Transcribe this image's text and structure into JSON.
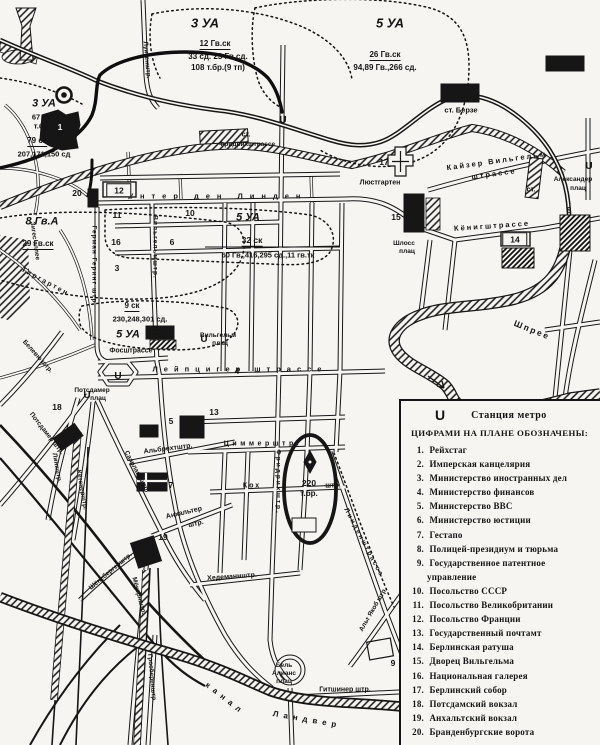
{
  "map": {
    "ink": "#141414",
    "paper": "#f6f5f1",
    "unit_labels": [
      {
        "t": "3 УА",
        "x": 205,
        "y": 23,
        "s": 13,
        "it": 1,
        "n": "unit-3ua-north"
      },
      {
        "t": "12 Гв.ск",
        "x": 215,
        "y": 45,
        "s": 8,
        "u": 1
      },
      {
        "t": "33 сд. 23 Гв.сд.",
        "x": 218,
        "y": 57,
        "s": 8
      },
      {
        "t": "108 т.бр.(9 тп)",
        "x": 218,
        "y": 68,
        "s": 8
      },
      {
        "t": "5 УА",
        "x": 390,
        "y": 23,
        "s": 13,
        "it": 1,
        "n": "unit-5ua-north"
      },
      {
        "t": "26 Гв.ск",
        "x": 385,
        "y": 56,
        "s": 8,
        "u": 1
      },
      {
        "t": "94,89 Гв.,266 сд.",
        "x": 385,
        "y": 68,
        "s": 8
      },
      {
        "t": "3 УА",
        "x": 44,
        "y": 104,
        "s": 11,
        "it": 1,
        "n": "unit-3ua-west"
      },
      {
        "t": "67 гв.",
        "x": 42,
        "y": 117,
        "s": 7.5
      },
      {
        "t": "т.бр.",
        "x": 42,
        "y": 126,
        "s": 7.5
      },
      {
        "t": "79 ск",
        "x": 37,
        "y": 142,
        "s": 8,
        "u": 1
      },
      {
        "t": "207,171,150 сд",
        "x": 44,
        "y": 154,
        "s": 7.5
      },
      {
        "t": "8 Гв.А",
        "x": 42,
        "y": 222,
        "s": 11,
        "it": 1,
        "n": "unit-8gva"
      },
      {
        "t": "29 Гв.ск",
        "x": 38,
        "y": 245,
        "s": 8,
        "u": 1
      },
      {
        "t": "5 УА",
        "x": 248,
        "y": 218,
        "s": 11,
        "it": 1,
        "n": "unit-5ua-center"
      },
      {
        "t": "32 ск",
        "x": 252,
        "y": 241,
        "s": 8.5,
        "u": 1
      },
      {
        "t": "60 Гв.,416,295 сд.,11 гв.тк",
        "x": 268,
        "y": 255,
        "s": 7.5
      },
      {
        "t": "9 ск",
        "x": 132,
        "y": 307,
        "s": 8,
        "u": 1
      },
      {
        "t": "230,248,301 сд.",
        "x": 140,
        "y": 319,
        "s": 7.5
      },
      {
        "t": "5 УА",
        "x": 128,
        "y": 335,
        "s": 11,
        "it": 1,
        "n": "unit-5ua-south"
      },
      {
        "t": "220",
        "x": 309,
        "y": 483,
        "s": 8.5,
        "n": "unit-220-tbr"
      },
      {
        "t": "т.бр.",
        "x": 309,
        "y": 494,
        "s": 8
      }
    ],
    "street_labels": [
      {
        "t": "Унтер ден Линден",
        "x": 218,
        "y": 196,
        "s": 7.5,
        "ls": 7
      },
      {
        "t": "Лейпцигер штрассе",
        "x": 240,
        "y": 369,
        "s": 7.5,
        "ls": 6
      },
      {
        "t": "Циммерштр.",
        "x": 263,
        "y": 444,
        "s": 7,
        "ls": 3.5
      },
      {
        "t": "Кох",
        "x": 252,
        "y": 486,
        "s": 7,
        "ls": 2
      },
      {
        "t": "штр.",
        "x": 333,
        "y": 486,
        "s": 7
      },
      {
        "t": "Альбрехтштр.",
        "x": 168,
        "y": 449,
        "s": 7,
        "r": -7
      },
      {
        "t": "Анхальтер",
        "x": 184,
        "y": 513,
        "s": 7,
        "r": -13
      },
      {
        "t": "штр.",
        "x": 196,
        "y": 524,
        "s": 7,
        "r": -13
      },
      {
        "t": "Хедеманнштр.",
        "x": 232,
        "y": 577,
        "s": 7,
        "r": -4
      },
      {
        "t": "Гитшинер штр.",
        "x": 345,
        "y": 690,
        "s": 7
      },
      {
        "t": "Фосштрассе",
        "x": 131,
        "y": 351,
        "s": 7
      },
      {
        "t": "Кёнигштрассе",
        "x": 492,
        "y": 226,
        "s": 7.5,
        "r": -4,
        "ls": 2
      },
      {
        "t": "Кайзер Вильгельм",
        "x": 497,
        "y": 161,
        "s": 7.5,
        "r": -8,
        "ls": 2
      },
      {
        "t": "штрассе",
        "x": 494,
        "y": 174,
        "s": 7.5,
        "r": -8,
        "ls": 2
      },
      {
        "t": "Люстгартен",
        "x": 380,
        "y": 183,
        "s": 7
      },
      {
        "t": "Шлосс",
        "x": 404,
        "y": 244,
        "s": 6.5
      },
      {
        "t": "плац",
        "x": 407,
        "y": 252,
        "s": 6.5
      },
      {
        "t": "Шпрее",
        "x": 532,
        "y": 330,
        "s": 8.5,
        "r": 22,
        "ls": 2
      },
      {
        "t": "канал",
        "x": 225,
        "y": 699,
        "s": 8,
        "r": 38,
        "ls": 5
      },
      {
        "t": "Ландвер",
        "x": 307,
        "y": 720,
        "s": 8,
        "r": 10,
        "ls": 5
      },
      {
        "t": "Альт Якоб штр.",
        "x": 374,
        "y": 610,
        "s": 6.5,
        "r": -60
      },
      {
        "t": "Линденштрассе",
        "x": 363,
        "y": 543,
        "s": 6.5,
        "r": 62,
        "ls": 2
      },
      {
        "t": "Фридрихштр.",
        "x": 277,
        "y": 482,
        "s": 6.5,
        "r": 90,
        "ls": 2
      },
      {
        "t": "Вильгельмштр.",
        "x": 154,
        "y": 247,
        "s": 6.5,
        "r": 90,
        "ls": 1
      },
      {
        "t": "Луизенштр.",
        "x": 146,
        "y": 60,
        "s": 6.5,
        "r": 85
      },
      {
        "t": "Герман Геринг штр.",
        "x": 93,
        "y": 266,
        "s": 6.5,
        "r": 90,
        "ls": 1
      },
      {
        "t": "Тиргартен",
        "x": 45,
        "y": 282,
        "s": 7,
        "r": 28,
        "ls": 2
      },
      {
        "t": "Зигес аллее",
        "x": 34,
        "y": 241,
        "s": 6.5,
        "r": 82
      },
      {
        "t": "Белевю штр.",
        "x": 37,
        "y": 357,
        "s": 6.5,
        "r": 48
      },
      {
        "t": "Потсдамер штр.",
        "x": 46,
        "y": 434,
        "s": 6.5,
        "r": 52
      },
      {
        "t": "Линкштр.",
        "x": 56,
        "y": 468,
        "s": 6.5,
        "r": 80
      },
      {
        "t": "Кётенерштр.",
        "x": 81,
        "y": 490,
        "s": 6.5,
        "r": 80
      },
      {
        "t": "Саарландштр.",
        "x": 136,
        "y": 472,
        "s": 6.5,
        "r": 62
      },
      {
        "t": "Мёкернштр.",
        "x": 138,
        "y": 596,
        "s": 6.5,
        "r": 75
      },
      {
        "t": "Гросберенштр.",
        "x": 151,
        "y": 678,
        "s": 6.5,
        "r": 85
      },
      {
        "t": "Шёнебергерштр.",
        "x": 111,
        "y": 572,
        "s": 6.5,
        "r": -40
      },
      {
        "t": "Потсдамер",
        "x": 92,
        "y": 391,
        "s": 6.5
      },
      {
        "t": "плац",
        "x": 98,
        "y": 399,
        "s": 6.5
      },
      {
        "t": "Вильгельм",
        "x": 218,
        "y": 336,
        "s": 6.5
      },
      {
        "t": "плац",
        "x": 220,
        "y": 344,
        "s": 6.5
      },
      {
        "t": "Бель",
        "x": 284,
        "y": 666,
        "s": 6.5
      },
      {
        "t": "Алианс",
        "x": 284,
        "y": 674,
        "s": 6.5
      },
      {
        "t": "плац",
        "x": 284,
        "y": 682,
        "s": 6.5
      },
      {
        "t": "ст.",
        "x": 246,
        "y": 135,
        "s": 7,
        "n": "station-friedrichstrasse-label"
      },
      {
        "t": "Фридрихштрассе",
        "x": 247,
        "y": 145,
        "s": 6.5
      },
      {
        "t": "ст. Берзе",
        "x": 461,
        "y": 110,
        "s": 7.5,
        "n": "station-boerse-label"
      },
      {
        "t": "ст.",
        "x": 531,
        "y": 190,
        "s": 7,
        "n": "station-alexanderplatz-label"
      },
      {
        "t": "Александер",
        "x": 573,
        "y": 180,
        "s": 6.5
      },
      {
        "t": "плац",
        "x": 578,
        "y": 189,
        "s": 6.5
      }
    ],
    "metro_marks": [
      {
        "x": 283,
        "y": 121
      },
      {
        "x": 118,
        "y": 377
      },
      {
        "x": 87,
        "y": 396
      },
      {
        "x": 204,
        "y": 340
      },
      {
        "x": 589,
        "y": 167
      }
    ],
    "markers": [
      {
        "no": "1",
        "x": 60,
        "y": 127,
        "white": 1
      },
      {
        "no": "2",
        "x": 156,
        "y": 332
      },
      {
        "no": "3",
        "x": 117,
        "y": 268
      },
      {
        "no": "4",
        "x": 237,
        "y": 371
      },
      {
        "no": "5",
        "x": 171,
        "y": 421
      },
      {
        "no": "6",
        "x": 172,
        "y": 242
      },
      {
        "no": "7",
        "x": 171,
        "y": 485
      },
      {
        "no": "8",
        "x": 569,
        "y": 210
      },
      {
        "no": "9",
        "x": 393,
        "y": 663
      },
      {
        "no": "10",
        "x": 190,
        "y": 213
      },
      {
        "no": "11",
        "x": 117,
        "y": 215
      },
      {
        "no": "12",
        "x": 119,
        "y": 190,
        "boxed": 1
      },
      {
        "no": "13",
        "x": 214,
        "y": 412
      },
      {
        "no": "14",
        "x": 515,
        "y": 239,
        "boxed": 1
      },
      {
        "no": "15",
        "x": 396,
        "y": 217
      },
      {
        "no": "16",
        "x": 116,
        "y": 242
      },
      {
        "no": "17",
        "x": 384,
        "y": 162
      },
      {
        "no": "18",
        "x": 57,
        "y": 407
      },
      {
        "no": "19",
        "x": 163,
        "y": 537
      },
      {
        "no": "20",
        "x": 77,
        "y": 193
      }
    ]
  },
  "legend": {
    "metro_symbol": "U",
    "metro_label": "Станция метро",
    "heading": "ЦИФРАМИ НА ПЛАНЕ ОБОЗНАЧЕНЫ:",
    "items": [
      {
        "no": "1.",
        "label": "Рейхстаг"
      },
      {
        "no": "2.",
        "label": "Имперская канцелярия"
      },
      {
        "no": "3.",
        "label": "Министерство иностранных дел"
      },
      {
        "no": "4.",
        "label": "Министерство финансов"
      },
      {
        "no": "5.",
        "label": "Министерство ВВС"
      },
      {
        "no": "6.",
        "label": "Министерство юстиции"
      },
      {
        "no": "7.",
        "label": "Гестапо"
      },
      {
        "no": "8.",
        "label": "Полицей-президиум и тюрьма"
      },
      {
        "no": "9.",
        "label": "Государственное патентное управление"
      },
      {
        "no": "10.",
        "label": "Посольство СССР"
      },
      {
        "no": "11.",
        "label": "Посольство Великобритании"
      },
      {
        "no": "12.",
        "label": "Посольство Франции"
      },
      {
        "no": "13.",
        "label": "Государственный почтамт"
      },
      {
        "no": "14.",
        "label": "Берлинская ратуша"
      },
      {
        "no": "15.",
        "label": "Дворец Вильгельма"
      },
      {
        "no": "16.",
        "label": "Национальная галерея"
      },
      {
        "no": "17.",
        "label": "Берлинский собор"
      },
      {
        "no": "18.",
        "label": "Потсдамский вокзал"
      },
      {
        "no": "19.",
        "label": "Анхальтский вокзал"
      },
      {
        "no": "20.",
        "label": "Бранденбургские ворота"
      }
    ]
  }
}
